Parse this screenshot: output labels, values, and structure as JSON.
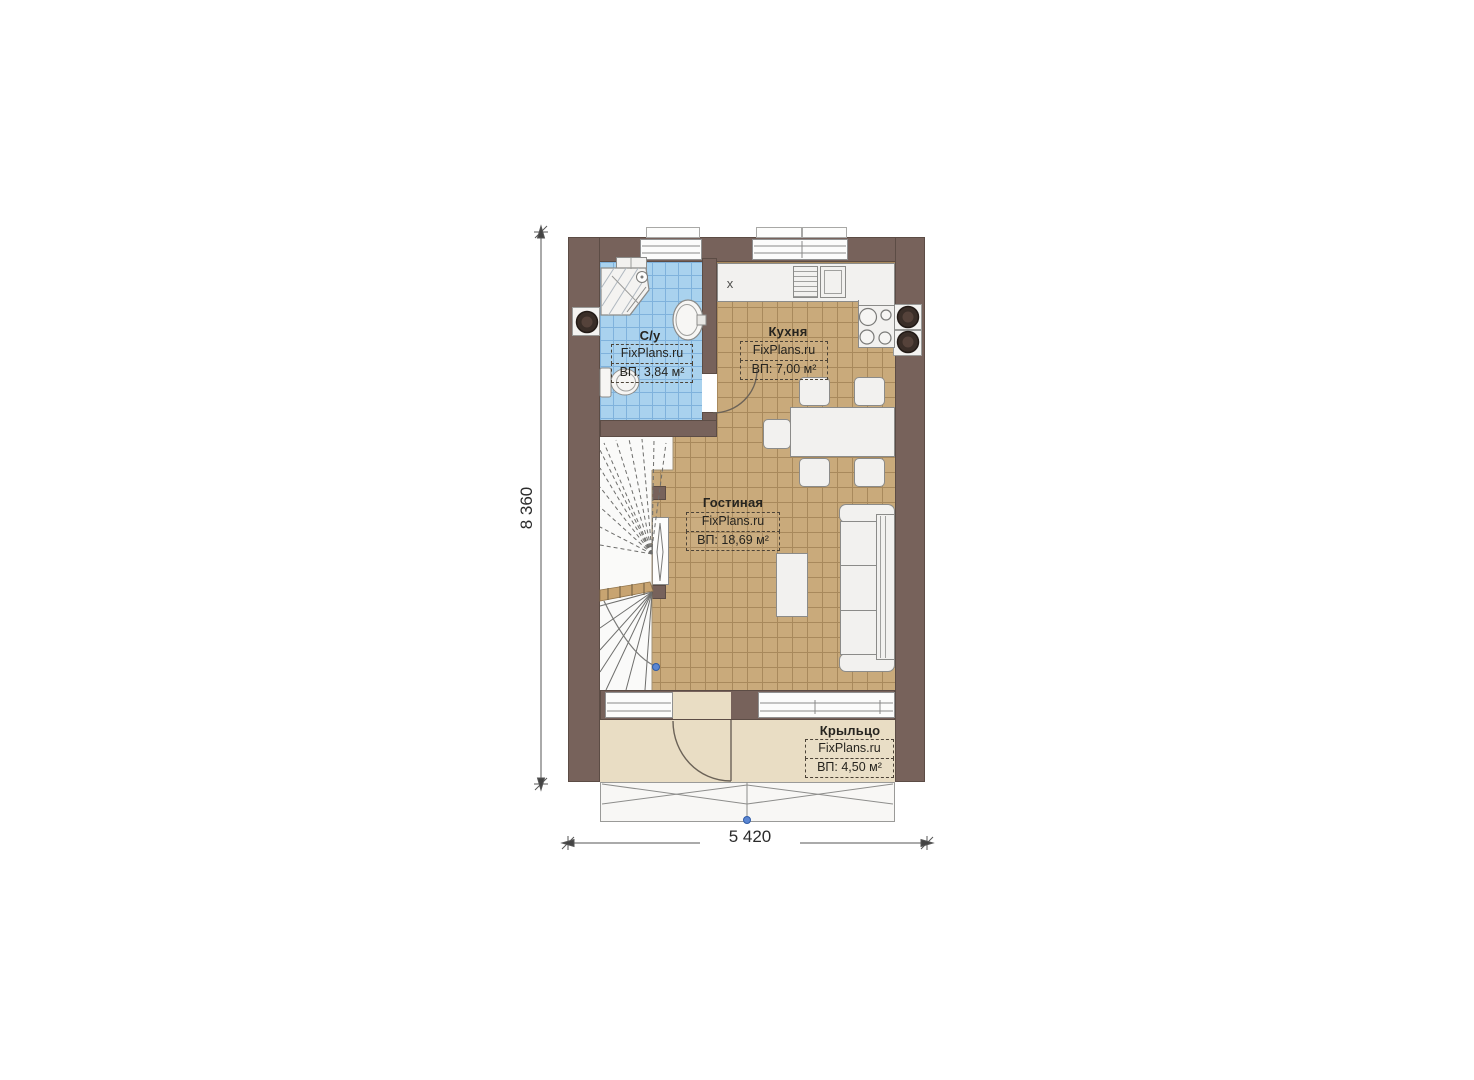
{
  "rooms": [
    {
      "name": "С/у",
      "watermark": "FixPlans.ru",
      "area_label": "ВП: 3,84 м²"
    },
    {
      "name": "Кухня",
      "watermark": "FixPlans.ru",
      "area_label": "ВП: 7,00 м²"
    },
    {
      "name": "Гостиная",
      "watermark": "FixPlans.ru",
      "area_label": "ВП: 18,69 м²"
    },
    {
      "name": "Крыльцо",
      "watermark": "FixPlans.ru",
      "area_label": "ВП: 4,50 м²"
    }
  ],
  "dimensions": {
    "overall_height": "8 360",
    "overall_width": "5 420"
  },
  "kitchen": {
    "counter_mark": "х"
  },
  "colors": {
    "wall": "#77625b",
    "bath_tile": "#a9d2ee",
    "floor_tile": "#c9aa7b",
    "porch_floor": "#e9ddc4",
    "fixture_white": "#f2f1ef",
    "marker_blue": "#4d7cc9"
  }
}
